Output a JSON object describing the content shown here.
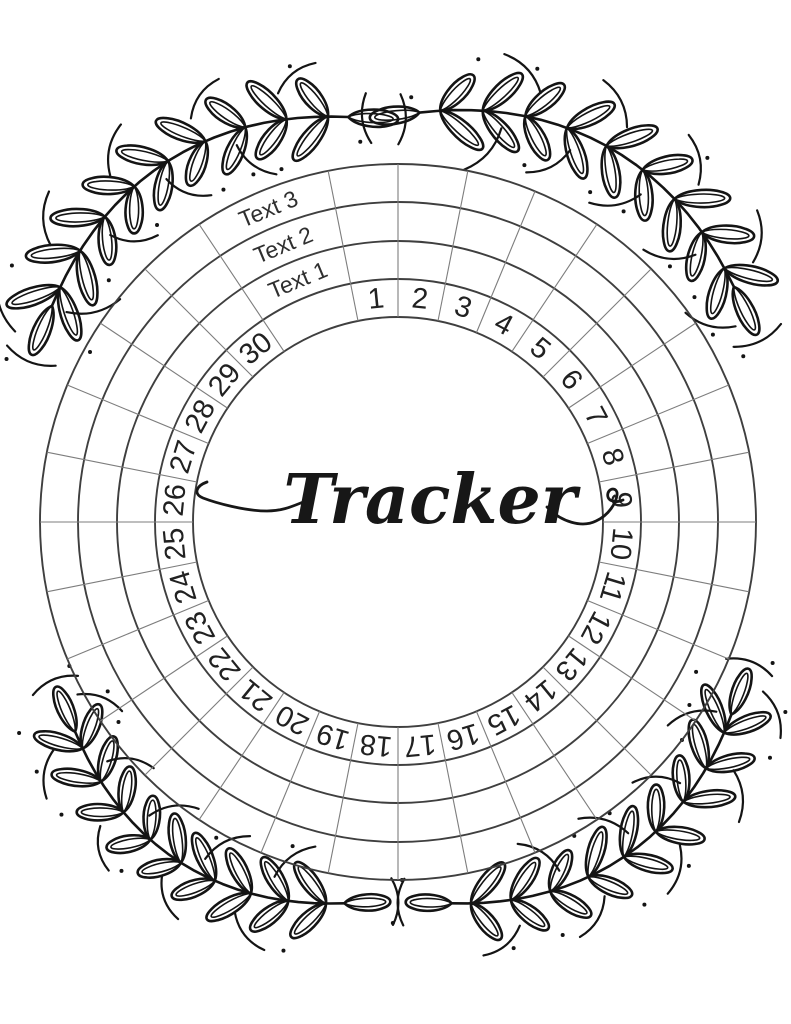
{
  "page": {
    "background_color": "#ffffff"
  },
  "tracker": {
    "title": "Tracker",
    "ring_labels": [
      "Text 1",
      "Text 2",
      "Text 3"
    ],
    "day_numbers": [
      "1",
      "2",
      "3",
      "4",
      "5",
      "6",
      "7",
      "8",
      "9",
      "10",
      "11",
      "12",
      "13",
      "14",
      "15",
      "16",
      "17",
      "18",
      "19",
      "20",
      "21",
      "22",
      "23",
      "24",
      "25",
      "26",
      "27",
      "28",
      "29",
      "30"
    ],
    "colors": {
      "ring_line": "#3f3f3f",
      "spoke_line": "#7d7d7d",
      "number_text": "#212121",
      "label_text": "#2f2f2f",
      "ink": "#141414"
    },
    "layout": {
      "center_x": 398,
      "center_y": 522,
      "ring_radii": [
        205,
        243,
        281,
        320,
        358
      ],
      "segment_degrees": 11.25,
      "label_gap_center_degrees": 337.5,
      "number_radius": 224,
      "label_radii": [
        262,
        300,
        339
      ]
    }
  },
  "decorations": {
    "motif": "laurel-branch",
    "corners": [
      "top-left",
      "top-right",
      "bottom-right",
      "bottom-left"
    ]
  }
}
